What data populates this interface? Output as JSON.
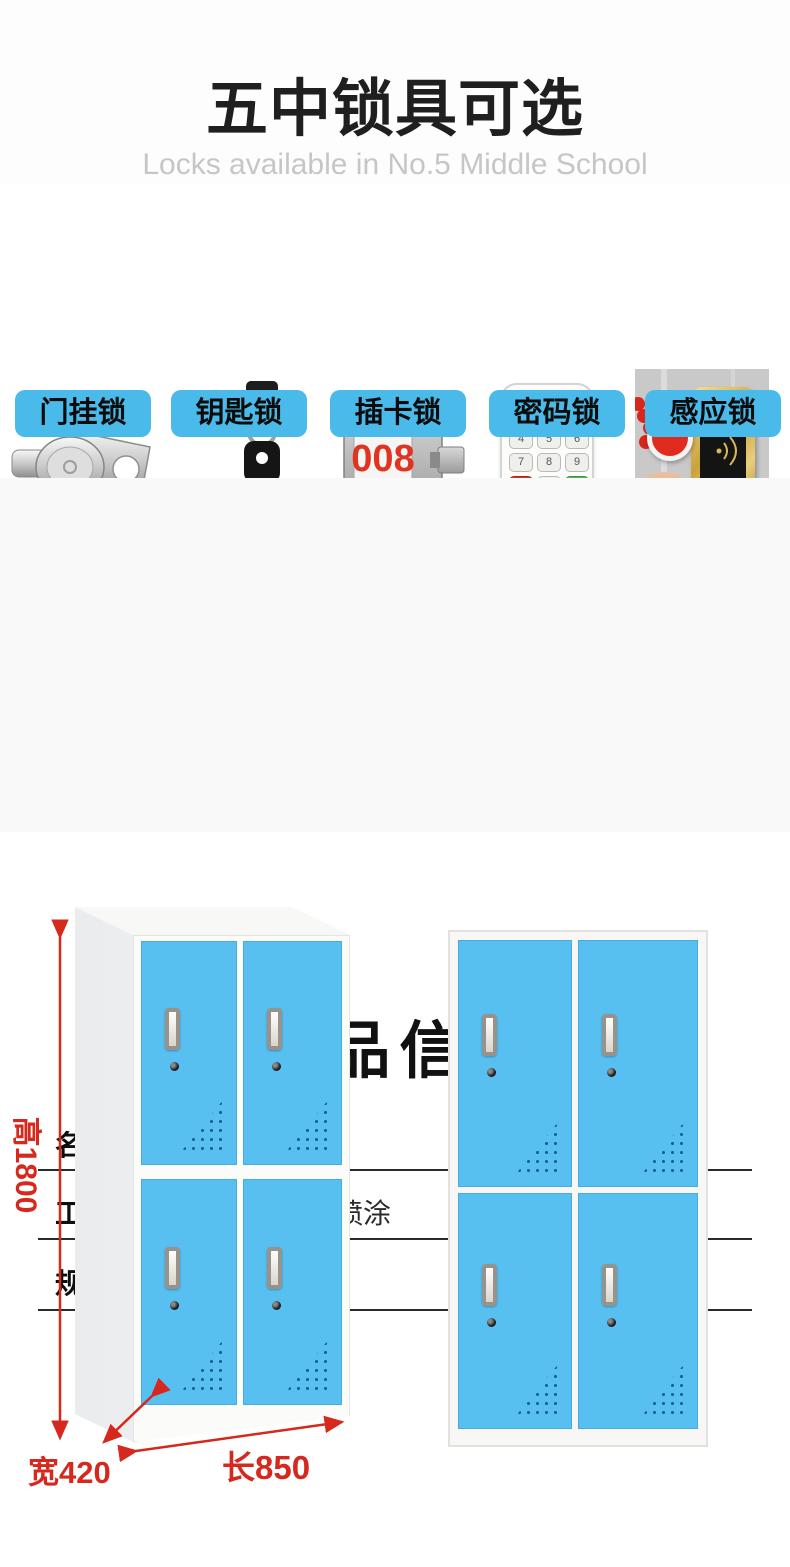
{
  "header": {
    "title": "五中锁具可选",
    "subtitle": "Locks available in No.5 Middle School"
  },
  "locks": {
    "card_display": "008",
    "keypad_keys": [
      "1",
      "2",
      "3",
      "4",
      "5",
      "6",
      "7",
      "8",
      "9",
      "C",
      "0",
      "↵"
    ],
    "items": [
      {
        "label": "门挂锁",
        "icon": "cam-lock-icon"
      },
      {
        "label": "钥匙锁",
        "icon": "key-lock-icon"
      },
      {
        "label": "插卡锁",
        "icon": "card-lock-icon"
      },
      {
        "label": "密码锁",
        "icon": "keypad-lock-icon"
      },
      {
        "label": "感应锁",
        "icon": "rfid-lock-icon"
      }
    ]
  },
  "product_info": {
    "title": "产品信息",
    "specs": {
      "name_label": "名称：",
      "name_value": "四门更衣柜",
      "material_label": "材质：",
      "material_value": "冷轧钢板",
      "craft_label": "工艺：",
      "craft_value": "热固性无磷静电喷涂",
      "color_label": "颜色：",
      "color_value": "白套蓝",
      "spec_label": "规格：",
      "spec_value": "见下列产品展示"
    }
  },
  "dimensions": {
    "height": "高1800",
    "width": "宽420",
    "length": "长850"
  },
  "colors": {
    "accent_blue": "#49bae9",
    "door_blue": "#58c0f1",
    "dimension_red": "#d6281c",
    "card_number_red": "#e03322"
  }
}
